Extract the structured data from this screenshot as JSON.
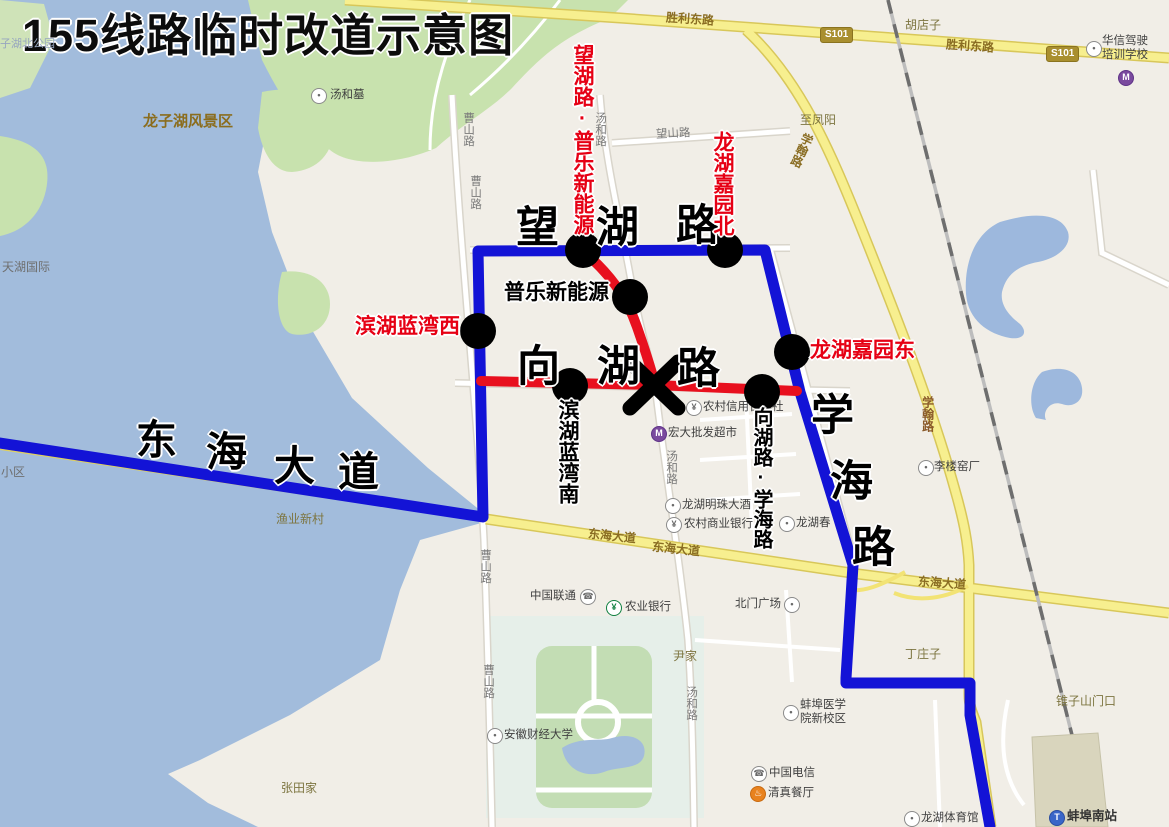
{
  "title": "155线路临时改道示意图",
  "colors": {
    "route_blue": "#1313d6",
    "route_red": "#e8101e",
    "stop_dot": "#000000",
    "water": "#a2bcdc",
    "greenland": "#c8e2ae",
    "yellow_road": "#f7ef8f"
  },
  "stops": {
    "wanghu_pule": "望湖路·普乐新能源",
    "longhu_jiayuan_bei": "龙湖嘉园北",
    "longhu_jiayuan_dong": "龙湖嘉园东",
    "binhu_lanwan_xi": "滨湖蓝湾西",
    "pule_xinnengyuan": "普乐新能源",
    "binhu_lanwan_nan": "滨湖蓝湾南",
    "xianghu_xuehai": "向湖路·学海路"
  },
  "roads_big": {
    "wanghu_chars": [
      "望",
      "湖",
      "路"
    ],
    "xianghu_chars": [
      "向",
      "湖",
      "路"
    ],
    "xuehai_chars": [
      "学",
      "海",
      "路"
    ],
    "donghai_chars": [
      "东",
      "海",
      "大",
      "道"
    ]
  },
  "road_labels": {
    "shengli_1": "胜利东路",
    "shengli_2": "胜利东路",
    "s101_1": "S101",
    "s101_2": "S101",
    "xuehan_1": "学翰路",
    "xuehan_2": "学翰路",
    "wangshan": "望山路",
    "tanghe_1": "汤和路",
    "tanghe_2": "汤和路",
    "tanghe_3": "汤和路",
    "caoshan_1": "曹山路",
    "caoshan_2": "曹山路",
    "caoshan_3": "曹山路",
    "caoshan_4": "曹山路",
    "donghai_1": "东海大道",
    "donghai_2": "东海大道",
    "donghai_3": "东海大道",
    "zhi_fengyang": "至凤阳"
  },
  "places": {
    "longzihu": "龙子湖风景区",
    "tianhu": "天湖国际",
    "xiaoqu": "小区",
    "zihubei_park": "子湖北公园",
    "hudianzi": "胡店子",
    "yujia_xincun": "渔业新村",
    "yinjia": "尹家",
    "zhangtianjia": "张田家",
    "dingzhuangzi": "丁庄子",
    "zhuizishan": "锥子山门口"
  },
  "pois": {
    "tanghemu": "汤和墓",
    "huaxin_line1": "华信驾驶",
    "huaxin_line2": "培训学校",
    "xinyongshe": "农村信用合作社",
    "hongda": "宏大批发超市",
    "mingzhu": "龙湖明珠大酒",
    "nongshang_bank": "农村商业银行",
    "longhu_chun": "龙湖春",
    "lilou": "李楼窑厂",
    "liantong": "中国联通",
    "nongye_bank": "农业银行",
    "beimen": "北门广场",
    "caijing_univ": "安徽财经大学",
    "yixue_line1": "蚌埠医学",
    "yixue_line2": "院新校区",
    "dianxin": "中国电信",
    "qingzhen": "清真餐厅",
    "tiyuguan": "龙湖体育馆",
    "nanzhan": "蚌埠南站"
  },
  "icons": {
    "dot": "•",
    "bank": "¥",
    "phone": "☎",
    "restaurant": "♨",
    "train": "T",
    "store": "M"
  }
}
